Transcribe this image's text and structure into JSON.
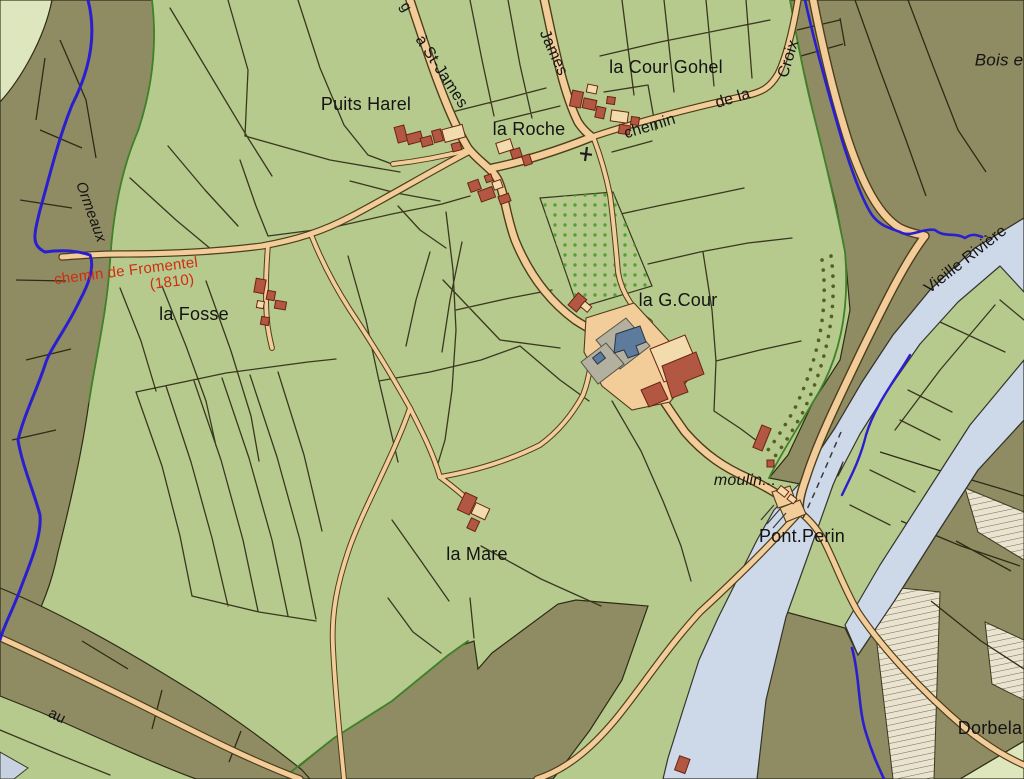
{
  "map": {
    "type": "historical cadastral map",
    "palette": {
      "field": "#b6ca8e",
      "field_pale": "#dde6bd",
      "olive": "#8f8b62",
      "line": "#3a381f",
      "olive_line": "#2e2c16",
      "road": "#f2cd9a",
      "road_edge": "#4f3d1c",
      "river": "#cdd8e8",
      "river_edge": "#35342c",
      "stream": "#2a1fd0",
      "hedge": "#3f8229",
      "building_red": "#b25842",
      "building_edge": "#6b2413",
      "building_cream": "#f2dcae",
      "chateau_slate": "#5d7b9c",
      "courtyard_grey": "#b3b0a0",
      "orchard_dot": "#55a032",
      "avenue_dot": "#555f20",
      "hatch_bg": "#eae3d0",
      "hatch_line": "#6f6a52",
      "label": "#141414",
      "label_red": "#d22b10",
      "pale_water": "#c6d2e2"
    },
    "labels": [
      {
        "id": "road-letter-g",
        "text": "g"
      },
      {
        "id": "road-a-st-james",
        "text": "à St-James"
      },
      {
        "id": "road-james",
        "text": "James"
      },
      {
        "id": "place-la-cour-gohel",
        "text": "la Cour Gohel"
      },
      {
        "id": "place-puits-harel",
        "text": "Puits Harel"
      },
      {
        "id": "place-la-roche",
        "text": "la Roche"
      },
      {
        "id": "road-chemin",
        "text": "chemin"
      },
      {
        "id": "road-de-la",
        "text": "de la"
      },
      {
        "id": "road-croix",
        "text": "Croix"
      },
      {
        "id": "place-bois",
        "text": "Bois e"
      },
      {
        "id": "stream-ormeaux",
        "text": "Ormeaux"
      },
      {
        "id": "road-chemin-de-fromentel",
        "text": "chemin de Fromentel"
      },
      {
        "id": "road-fromentel-year",
        "text": "(1810)"
      },
      {
        "id": "place-la-fosse",
        "text": "la Fosse"
      },
      {
        "id": "place-la-g-cour",
        "text": "la G.Cour"
      },
      {
        "id": "place-moulin",
        "text": "moulin..."
      },
      {
        "id": "place-pont-perin",
        "text": "Pont.Perin"
      },
      {
        "id": "place-la-mare",
        "text": "la Mare"
      },
      {
        "id": "river-vieille-riviere",
        "text": "Vieille Rivière"
      },
      {
        "id": "place-dorbela",
        "text": "Dorbela"
      },
      {
        "id": "road-au",
        "text": "au"
      }
    ]
  }
}
